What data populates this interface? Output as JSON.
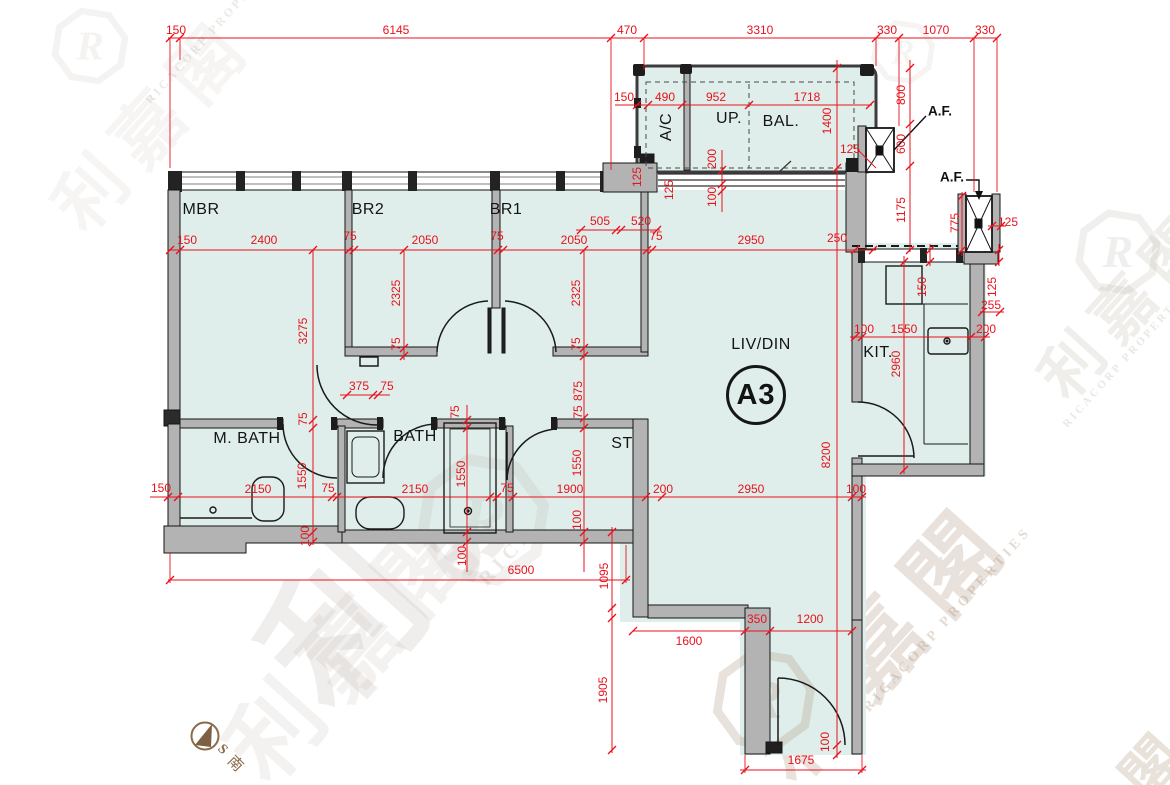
{
  "unit": {
    "label": "A3"
  },
  "rooms": [
    {
      "t": "MBR",
      "x": 201,
      "y": 210
    },
    {
      "t": "BR2",
      "x": 368,
      "y": 210
    },
    {
      "t": "BR1",
      "x": 506,
      "y": 210
    },
    {
      "t": "M. BATH",
      "x": 247,
      "y": 439
    },
    {
      "t": "BATH",
      "x": 415,
      "y": 437
    },
    {
      "t": "ST",
      "x": 622,
      "y": 444
    },
    {
      "t": "LIV/DIN",
      "x": 761,
      "y": 345
    },
    {
      "t": "KIT.",
      "x": 878,
      "y": 353
    },
    {
      "t": "UP.",
      "x": 729,
      "y": 119
    },
    {
      "t": "BAL.",
      "x": 781,
      "y": 122
    },
    {
      "t": "A/C",
      "x": 667,
      "y": 127,
      "r": -90
    }
  ],
  "af_labels": [
    {
      "t": "A.F.",
      "x": 940,
      "y": 111
    },
    {
      "t": "A.F.",
      "x": 952,
      "y": 177
    }
  ],
  "compass": {
    "letter": "S",
    "char": "南"
  },
  "dimensions": [
    {
      "t": "150",
      "x": 176,
      "y": 30
    },
    {
      "t": "6145",
      "x": 396,
      "y": 30
    },
    {
      "t": "470",
      "x": 627,
      "y": 30
    },
    {
      "t": "3310",
      "x": 760,
      "y": 30
    },
    {
      "t": "330",
      "x": 887,
      "y": 30
    },
    {
      "t": "1070",
      "x": 936,
      "y": 30
    },
    {
      "t": "330",
      "x": 985,
      "y": 30
    },
    {
      "t": "150",
      "x": 624,
      "y": 97
    },
    {
      "t": "490",
      "x": 665,
      "y": 97
    },
    {
      "t": "952",
      "x": 716,
      "y": 97
    },
    {
      "t": "1718",
      "x": 807,
      "y": 97
    },
    {
      "t": "1400",
      "x": 827,
      "y": 121,
      "r": -90
    },
    {
      "t": "800",
      "x": 901,
      "y": 95,
      "r": -90
    },
    {
      "t": "600",
      "x": 901,
      "y": 144,
      "r": -90
    },
    {
      "t": "1175",
      "x": 901,
      "y": 210,
      "r": -90
    },
    {
      "t": "775",
      "x": 955,
      "y": 223,
      "r": -90
    },
    {
      "t": "125",
      "x": 1008,
      "y": 222
    },
    {
      "t": "125",
      "x": 850,
      "y": 149
    },
    {
      "t": "255",
      "x": 991,
      "y": 305
    },
    {
      "t": "150",
      "x": 922,
      "y": 287,
      "r": -90
    },
    {
      "t": "125",
      "x": 992,
      "y": 287,
      "r": -90
    },
    {
      "t": "100",
      "x": 864,
      "y": 329
    },
    {
      "t": "1550",
      "x": 904,
      "y": 329
    },
    {
      "t": "200",
      "x": 986,
      "y": 329
    },
    {
      "t": "2960",
      "x": 896,
      "y": 364,
      "r": -90
    },
    {
      "t": "505",
      "x": 600,
      "y": 221
    },
    {
      "t": "520",
      "x": 641,
      "y": 221
    },
    {
      "t": "125",
      "x": 637,
      "y": 177,
      "r": -90
    },
    {
      "t": "125",
      "x": 669,
      "y": 190,
      "r": -90
    },
    {
      "t": "200",
      "x": 712,
      "y": 159,
      "r": -90
    },
    {
      "t": "100",
      "x": 712,
      "y": 197,
      "r": -90
    },
    {
      "t": "150",
      "x": 187,
      "y": 240
    },
    {
      "t": "2400",
      "x": 264,
      "y": 240
    },
    {
      "t": "75",
      "x": 350,
      "y": 236
    },
    {
      "t": "2050",
      "x": 425,
      "y": 240
    },
    {
      "t": "75",
      "x": 497,
      "y": 236
    },
    {
      "t": "2050",
      "x": 574,
      "y": 240
    },
    {
      "t": "75",
      "x": 656,
      "y": 236
    },
    {
      "t": "2950",
      "x": 751,
      "y": 240
    },
    {
      "t": "250",
      "x": 837,
      "y": 238
    },
    {
      "t": "3275",
      "x": 303,
      "y": 331,
      "r": -90
    },
    {
      "t": "2325",
      "x": 396,
      "y": 293,
      "r": -90
    },
    {
      "t": "75",
      "x": 396,
      "y": 344,
      "r": -90
    },
    {
      "t": "2325",
      "x": 576,
      "y": 293,
      "r": -90
    },
    {
      "t": "75",
      "x": 576,
      "y": 344,
      "r": -90
    },
    {
      "t": "875",
      "x": 578,
      "y": 391,
      "r": -90
    },
    {
      "t": "75",
      "x": 578,
      "y": 412,
      "r": -90
    },
    {
      "t": "375",
      "x": 359,
      "y": 386
    },
    {
      "t": "75",
      "x": 387,
      "y": 386
    },
    {
      "t": "75",
      "x": 303,
      "y": 419,
      "r": -90
    },
    {
      "t": "1550",
      "x": 302,
      "y": 476,
      "r": -90
    },
    {
      "t": "100",
      "x": 305,
      "y": 536,
      "r": -90
    },
    {
      "t": "75",
      "x": 455,
      "y": 412,
      "r": -90
    },
    {
      "t": "1550",
      "x": 461,
      "y": 474,
      "r": -90
    },
    {
      "t": "100",
      "x": 462,
      "y": 556,
      "r": -90
    },
    {
      "t": "1550",
      "x": 577,
      "y": 463,
      "r": -90
    },
    {
      "t": "100",
      "x": 577,
      "y": 520,
      "r": -90
    },
    {
      "t": "150",
      "x": 161,
      "y": 488
    },
    {
      "t": "2150",
      "x": 258,
      "y": 489
    },
    {
      "t": "75",
      "x": 328,
      "y": 488
    },
    {
      "t": "2150",
      "x": 415,
      "y": 489
    },
    {
      "t": "75",
      "x": 507,
      "y": 488
    },
    {
      "t": "1900",
      "x": 570,
      "y": 489
    },
    {
      "t": "200",
      "x": 663,
      "y": 489
    },
    {
      "t": "2950",
      "x": 751,
      "y": 489
    },
    {
      "t": "100",
      "x": 856,
      "y": 489
    },
    {
      "t": "6500",
      "x": 521,
      "y": 570
    },
    {
      "t": "1095",
      "x": 604,
      "y": 576,
      "r": -90
    },
    {
      "t": "1905",
      "x": 603,
      "y": 690,
      "r": -90
    },
    {
      "t": "1600",
      "x": 689,
      "y": 641
    },
    {
      "t": "350",
      "x": 757,
      "y": 619
    },
    {
      "t": "1200",
      "x": 810,
      "y": 619
    },
    {
      "t": "100",
      "x": 825,
      "y": 742,
      "r": -90
    },
    {
      "t": "1675",
      "x": 801,
      "y": 760
    },
    {
      "t": "8200",
      "x": 826,
      "y": 455,
      "r": -90
    }
  ],
  "watermarks": [
    {
      "t": "利嘉閣",
      "x": 470,
      "y": 468,
      "r": -48,
      "s": 150,
      "c": "#a3948a",
      "o": 0.15,
      "ls": 35
    },
    {
      "t": "RICACORP PROPERTIES",
      "x": 601,
      "y": 452,
      "r": -48,
      "s": 20,
      "c": "#a3948a",
      "o": 0.22,
      "ls": 6
    },
    {
      "t": "RICACORP PROPERTIES",
      "x": 215,
      "y": 28,
      "r": -48,
      "s": 12,
      "c": "#b9b0a6",
      "o": 0.28,
      "ls": 3
    },
    {
      "t": "利嘉閣",
      "x": 878,
      "y": 636,
      "r": -48,
      "s": 92,
      "c": "#a98f76",
      "o": 0.25,
      "ls": 20
    },
    {
      "t": "RICACORP PROPERTIES",
      "x": 948,
      "y": 620,
      "r": -48,
      "s": 14,
      "c": "#a98f76",
      "o": 0.32,
      "ls": 4
    },
    {
      "t": "利嘉閣",
      "x": 1124,
      "y": 300,
      "r": -48,
      "s": 62,
      "c": "#b6aca0",
      "o": 0.2,
      "ls": 14
    },
    {
      "t": "RICACORP PROPERTIES",
      "x": 1128,
      "y": 356,
      "r": -48,
      "s": 11,
      "c": "#b6aca0",
      "o": 0.28,
      "ls": 3
    },
    {
      "t": "利嘉閣",
      "x": 352,
      "y": 636,
      "r": -48,
      "s": 92,
      "c": "#b3a89a",
      "o": 0.14,
      "ls": 20
    },
    {
      "t": "利嘉閣",
      "x": 150,
      "y": 120,
      "r": -48,
      "s": 70,
      "c": "#c0b8ae",
      "o": 0.13,
      "ls": 16
    },
    {
      "t": "閣",
      "x": 1148,
      "y": 764,
      "r": -48,
      "s": 58,
      "c": "#b09a80",
      "o": 0.28,
      "ls": 0
    }
  ],
  "colors": {
    "floor": "#dfeeea",
    "wall": "#b3b3b3",
    "wall_dark": "#222222",
    "dim_red": "#e8121c",
    "compass_brown": "#8a6a4a"
  }
}
